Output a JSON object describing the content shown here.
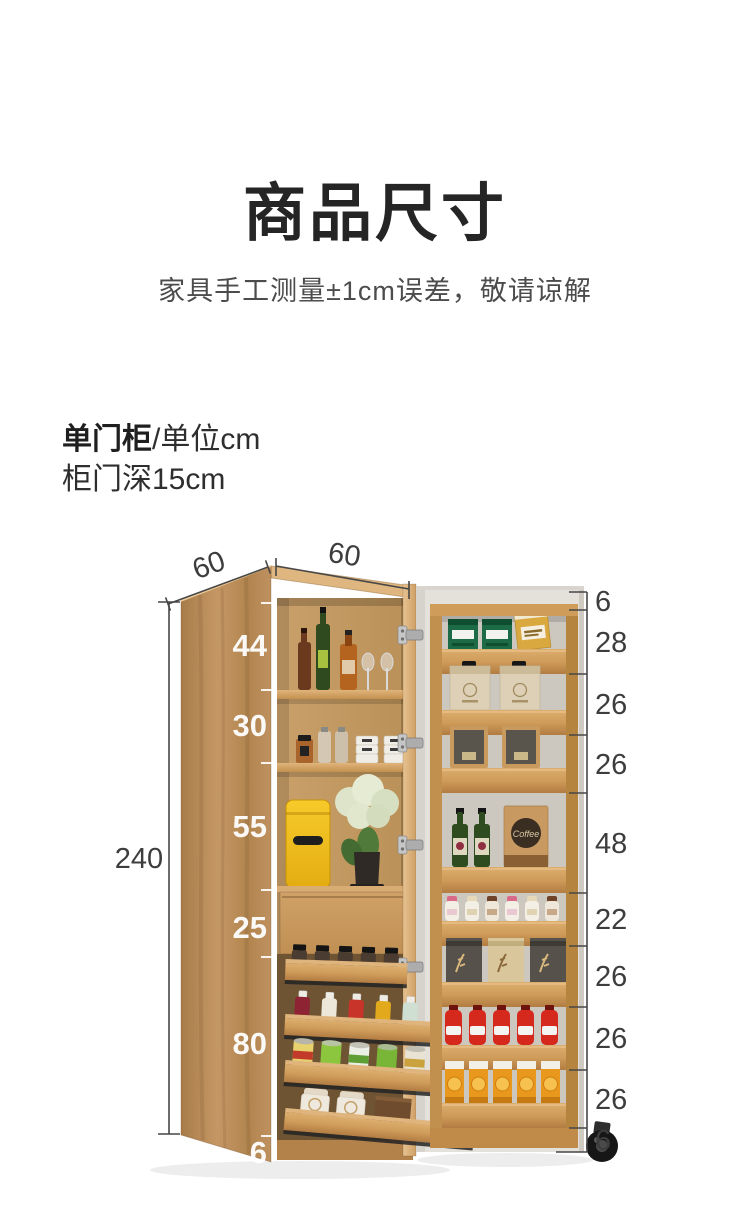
{
  "header": {
    "title": "商品尺寸",
    "subtitle": "家具手工测量±1cm误差，敬请谅解"
  },
  "product": {
    "type_label": "单门柜",
    "unit_label": "/单位cm",
    "door_depth_label": "柜门深15cm"
  },
  "dimensions": {
    "unit": "cm",
    "total_height": "240",
    "side_depth": "60",
    "front_width": "60",
    "cabinet_sections": [
      "44",
      "30",
      "55",
      "25",
      "80",
      "6"
    ],
    "door_sections": [
      "6",
      "28",
      "26",
      "26",
      "48",
      "22",
      "26",
      "26",
      "26",
      "6"
    ]
  },
  "products": {
    "coffee_label": "Coffee"
  },
  "colors": {
    "wood": "#c29463",
    "wood_dark": "#a87c49",
    "door_face": "#e4e1da",
    "accent_yellow": "#f2c11d",
    "dim_line": "#474747",
    "text_dark": "#252525",
    "text_gray": "#4c4c4c"
  }
}
